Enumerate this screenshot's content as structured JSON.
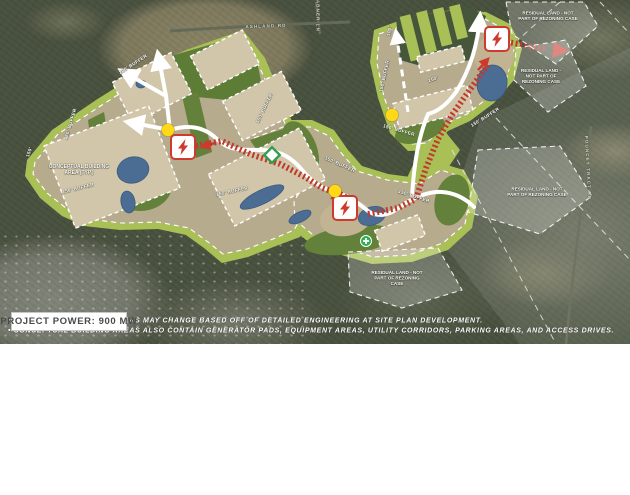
{
  "header": {
    "project_power_label": "PROJECT POWER: 900 MW"
  },
  "footnotes": {
    "line1": "• CONCEPTUAL BUILDING AREAS MAY CHANGE BASED OFF OF DETAILED ENGINEERING AT SITE PLAN DEVELOPMENT.",
    "line2": "• CONCEPTUAL BUILDING AREAS ALSO CONTAIN GENERATOR PADS, EQUIPMENT AREAS, UTILITY CORRIDORS, PARKING AREAS, AND ACCESS DRIVES."
  },
  "map": {
    "area_labels": {
      "conceptual_building": "CONCEPTUAL BUILDING AREA (TYP.)",
      "residual_land": "RESIDUAL LAND - NOT PART OF REZONING CASE"
    },
    "road_labels": [
      {
        "text": "ASHLAND RD",
        "x": 266,
        "y": 26,
        "r": -2
      },
      {
        "text": "ABNER LN",
        "x": 318,
        "y": 16,
        "r": 90
      },
      {
        "text": "POUNCEY TRACT RD",
        "x": 588,
        "y": 168,
        "r": 87
      }
    ],
    "residual_label_positions": [
      {
        "x": 548,
        "y": 16,
        "w": 60
      },
      {
        "x": 541,
        "y": 76,
        "w": 44
      },
      {
        "x": 537,
        "y": 192,
        "w": 60
      },
      {
        "x": 397,
        "y": 278,
        "w": 54
      }
    ],
    "buffer_labels": [
      {
        "text": "200' BUFFER",
        "x": 133,
        "y": 64,
        "r": -33
      },
      {
        "text": "150' BUFFER",
        "x": 70,
        "y": 124,
        "r": -73
      },
      {
        "text": "150'",
        "x": 29,
        "y": 152,
        "r": -70
      },
      {
        "text": "150' BUFFER",
        "x": 78,
        "y": 188,
        "r": -14
      },
      {
        "text": "150' BUFFER",
        "x": 232,
        "y": 191,
        "r": -12
      },
      {
        "text": "150' BUFFER",
        "x": 264,
        "y": 108,
        "r": -64
      },
      {
        "text": "150' BUFFER",
        "x": 340,
        "y": 164,
        "r": 24
      },
      {
        "text": "150' BUFFER",
        "x": 414,
        "y": 196,
        "r": 18
      },
      {
        "text": "150' BUFFER",
        "x": 399,
        "y": 130,
        "r": 16
      },
      {
        "text": "150' BUFFER",
        "x": 384,
        "y": 76,
        "r": -78
      },
      {
        "text": "100'",
        "x": 389,
        "y": 31,
        "r": -80
      },
      {
        "text": "150'",
        "x": 433,
        "y": 79,
        "r": -18
      },
      {
        "text": "150' BUFFER",
        "x": 485,
        "y": 117,
        "r": -32
      }
    ],
    "icons": [
      {
        "name": "substation-icon",
        "glyph": "lightning-bolt",
        "x": 183,
        "y": 147
      },
      {
        "name": "substation-icon",
        "glyph": "lightning-bolt",
        "x": 345,
        "y": 208
      },
      {
        "name": "substation-icon",
        "glyph": "lightning-bolt",
        "x": 497,
        "y": 39
      },
      {
        "name": "poi-dot-icon",
        "glyph": "yellow-circle",
        "x": 168,
        "y": 130
      },
      {
        "name": "poi-dot-icon",
        "glyph": "yellow-circle",
        "x": 335,
        "y": 191
      },
      {
        "name": "poi-dot-icon",
        "glyph": "yellow-circle",
        "x": 392,
        "y": 115
      },
      {
        "name": "utility-diamond-icon",
        "glyph": "green-diamond",
        "x": 272,
        "y": 155
      },
      {
        "name": "utility-cross-icon",
        "glyph": "green-plus-circle",
        "x": 366,
        "y": 241
      }
    ],
    "colors": {
      "buffer_green": "#a9c057",
      "interior_green": "#63813a",
      "pad_tan": "#d2c6aa",
      "pond_blue": "#4b6d94",
      "corridor_red": "#c0392b",
      "road_white": "#ffffff",
      "poi_yellow": "#ffd918",
      "marker_green": "#2fae55",
      "substation_red": "#ce3b2e"
    }
  }
}
